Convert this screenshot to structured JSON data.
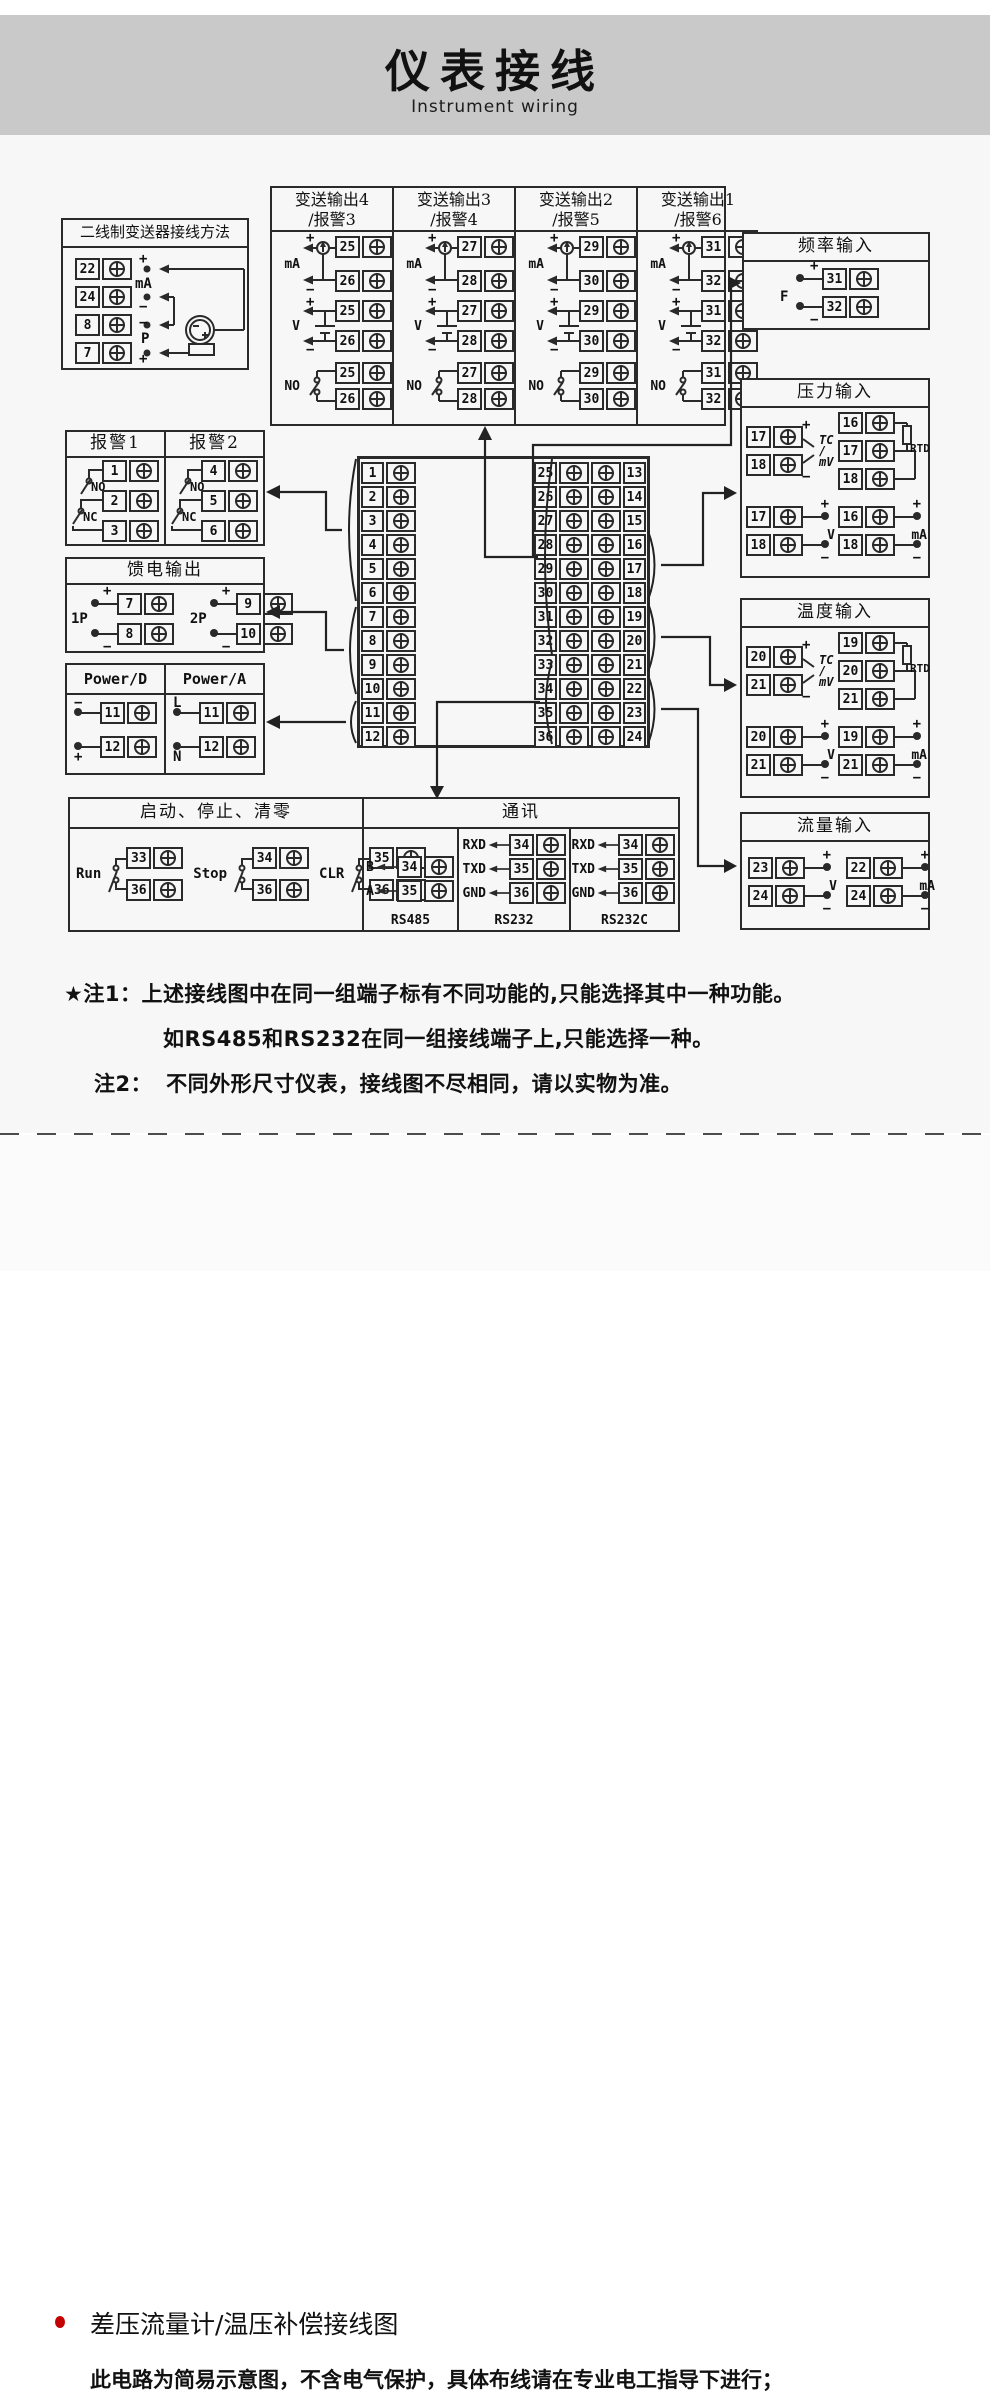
{
  "header": {
    "title": "仪表接线",
    "subtitle": "Instrument wiring"
  },
  "sym": {
    "plus": "+",
    "minus": "−"
  },
  "two_wire": {
    "title": "二线制变送器接线方法",
    "ma_label": "mA",
    "p_label": "P",
    "rows": [
      {
        "num": "22",
        "sign": "+"
      },
      {
        "num": "24",
        "sign": "−"
      },
      {
        "num": "8",
        "sign": "−"
      },
      {
        "num": "7",
        "sign": "+"
      }
    ]
  },
  "outputs": {
    "labels": {
      "ma": "mA",
      "v": "V",
      "no": "NO"
    },
    "columns": [
      {
        "title1": "变送输出4",
        "title2": "/报警3",
        "top": "25",
        "bottom": "26"
      },
      {
        "title1": "变送输出3",
        "title2": "/报警4",
        "top": "27",
        "bottom": "28"
      },
      {
        "title1": "变送输出2",
        "title2": "/报警5",
        "top": "29",
        "bottom": "30"
      },
      {
        "title1": "变送输出1",
        "title2": "/报警6",
        "top": "31",
        "bottom": "32"
      }
    ]
  },
  "freq": {
    "title": "频率输入",
    "label": "F",
    "top": "31",
    "bottom": "32"
  },
  "pressure": {
    "title": "压力输入",
    "tc": {
      "top": "17",
      "bottom": "18",
      "l1": "TC",
      "l2": "/",
      "l3": "mV"
    },
    "rtd": {
      "a": "16",
      "b": "17",
      "c": "18",
      "label": "RTD"
    },
    "v": {
      "top": "17",
      "bottom": "18",
      "label": "V"
    },
    "ma": {
      "top": "16",
      "bottom": "18",
      "label": "mA"
    }
  },
  "temp": {
    "title": "温度输入",
    "tc": {
      "top": "20",
      "bottom": "21",
      "l1": "TC",
      "l2": "/",
      "l3": "mV"
    },
    "rtd": {
      "a": "19",
      "b": "20",
      "c": "21",
      "label": "RTD"
    },
    "v": {
      "top": "20",
      "bottom": "21",
      "label": "V"
    },
    "ma": {
      "top": "19",
      "bottom": "21",
      "label": "mA"
    }
  },
  "flow": {
    "title": "流量输入",
    "v": {
      "top": "23",
      "bottom": "24",
      "label": "V"
    },
    "ma": {
      "top": "22",
      "bottom": "24",
      "label": "mA"
    }
  },
  "alarm": {
    "no_label": "NO",
    "nc_label": "NC",
    "cols": [
      {
        "title": "报警1",
        "t1": "1",
        "t2": "2",
        "t3": "3"
      },
      {
        "title": "报警2",
        "t1": "4",
        "t2": "5",
        "t3": "6"
      }
    ]
  },
  "feed": {
    "title": "馈电输出",
    "groups": [
      {
        "label": "1P",
        "top": "7",
        "bottom": "8"
      },
      {
        "label": "2P",
        "top": "9",
        "bottom": "10"
      }
    ]
  },
  "power": {
    "cols": [
      {
        "title": "Power/D",
        "sign_top": "−",
        "sign_bottom": "+",
        "top": "11",
        "bottom": "12"
      },
      {
        "title": "Power/A",
        "sign_top": "L",
        "sign_bottom": "N",
        "top": "11",
        "bottom": "12"
      }
    ]
  },
  "center": {
    "left": [
      "1",
      "2",
      "3",
      "4",
      "5",
      "6",
      "7",
      "8",
      "9",
      "10",
      "11",
      "12"
    ],
    "right": [
      {
        "l": "25",
        "r": "13"
      },
      {
        "l": "26",
        "r": "14"
      },
      {
        "l": "27",
        "r": "15"
      },
      {
        "l": "28",
        "r": "16"
      },
      {
        "l": "29",
        "r": "17"
      },
      {
        "l": "30",
        "r": "18"
      },
      {
        "l": "31",
        "r": "19"
      },
      {
        "l": "32",
        "r": "20"
      },
      {
        "l": "33",
        "r": "21"
      },
      {
        "l": "34",
        "r": "22"
      },
      {
        "l": "35",
        "r": "23"
      },
      {
        "l": "36",
        "r": "24"
      }
    ]
  },
  "control": {
    "title": "启动、停止、清零",
    "groups": [
      {
        "label": "Run",
        "top": "33",
        "bottom": "36"
      },
      {
        "label": "Stop",
        "top": "34",
        "bottom": "36"
      },
      {
        "label": "CLR",
        "top": "35",
        "bottom": "36"
      }
    ]
  },
  "comm": {
    "title": "通讯",
    "rs485": {
      "name": "RS485",
      "rows": [
        {
          "label": "B",
          "num": "34"
        },
        {
          "label": "A",
          "num": "35"
        }
      ]
    },
    "rs232": {
      "name": "RS232",
      "rows": [
        {
          "label": "RXD",
          "num": "34"
        },
        {
          "label": "TXD",
          "num": "35"
        },
        {
          "label": "GND",
          "num": "36"
        }
      ]
    },
    "rs232c": {
      "name": "RS232C",
      "rows": [
        {
          "label": "RXD",
          "num": "34"
        },
        {
          "label": "TXD",
          "num": "35"
        },
        {
          "label": "GND",
          "num": "36"
        }
      ]
    }
  },
  "notes": {
    "n1_label": "★注1：",
    "n1_line1": "上述接线图中在同一组端子标有不同功能的,只能选择其中一种功能。",
    "n1_line2": "如RS485和RS232在同一组接线端子上,只能选择一种。",
    "n2_label": "注2：",
    "n2_text": "不同外形尺寸仪表，接线图不尽相同，请以实物为准。"
  },
  "footer": {
    "title": "差压流量计/温压补偿接线图",
    "note": "此电路为简易示意图，不含电气保护，具体布线请在专业电工指导下进行；"
  },
  "colors": {
    "header_bg": "#c9c9c9",
    "line": "#2a2a2a",
    "bullet": "#c40000",
    "bg": "#f7f7f7"
  }
}
